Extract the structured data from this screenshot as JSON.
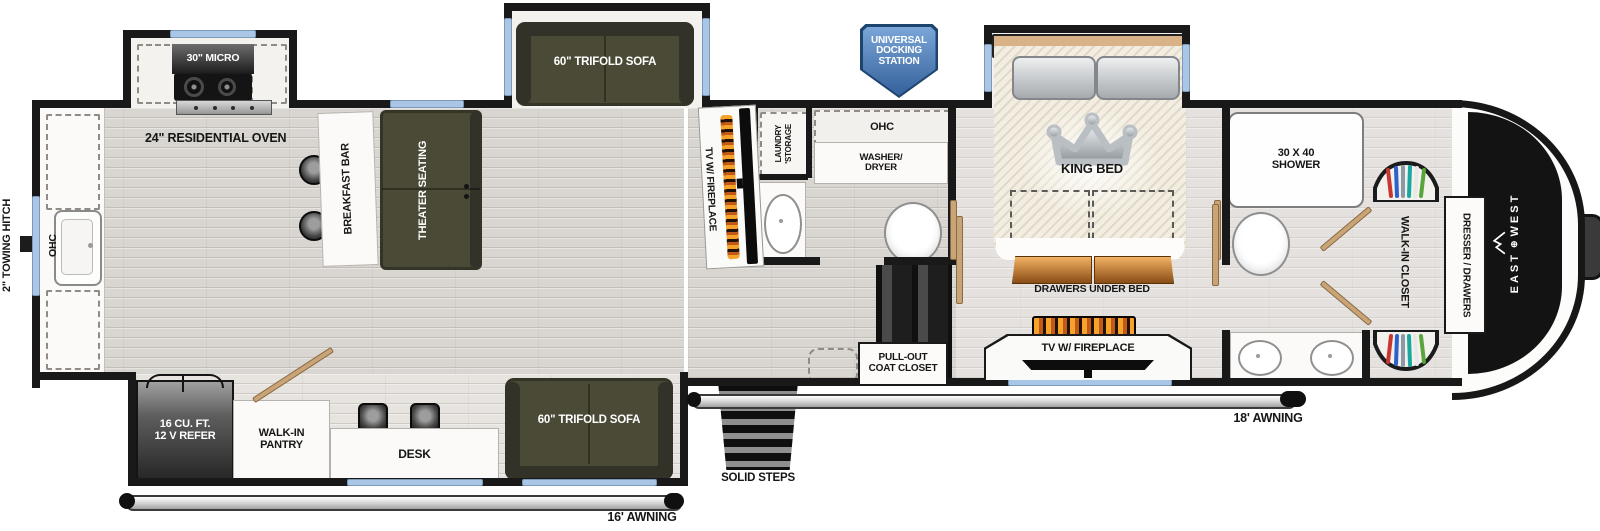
{
  "colors": {
    "wall": "#191919",
    "floor_wood": "#d9d5d0",
    "slide_floor": "#f3f2ef",
    "window_blue": "#a9c6e6",
    "sofa_olive": "#4a4a37",
    "wood_drawers": "#c9803c",
    "badge_blue": "#4a76ad",
    "tan_door": "#c9a477",
    "flame_orange": "#f2a12c"
  },
  "exterior": {
    "towing_hitch": "2\" TOWING HITCH",
    "docking": [
      "UNIVERSAL",
      "DOCKING",
      "STATION"
    ],
    "awning_rear": "16' AWNING",
    "awning_main": "18' AWNING",
    "solid_steps": "SOLID STEPS",
    "brand": {
      "east": "EAST",
      "mark": "⊕",
      "west": "WEST"
    }
  },
  "kitchen": {
    "ohc": "OHC",
    "micro": "30\" MICRO",
    "oven": "24\" RESIDENTIAL OVEN",
    "breakfast_bar": "BREAKFAST BAR",
    "refer": [
      "16 CU. FT.",
      "12 V REFER"
    ],
    "pantry": [
      "WALK-IN",
      "PANTRY"
    ],
    "desk": "DESK"
  },
  "living": {
    "theater": "THEATER SEATING",
    "sofa_top": "60\" TRIFOLD SOFA",
    "sofa_bottom": "60\" TRIFOLD SOFA",
    "tv_fireplace": "TV W/ FIREPLACE",
    "coat_closet": [
      "PULL-OUT",
      "COAT CLOSET"
    ]
  },
  "bath": {
    "laundry": [
      "LAUNDRY",
      "'STORAGE"
    ],
    "ohc": "OHC",
    "washer": [
      "WASHER/",
      "DRYER"
    ]
  },
  "bedroom": {
    "king_bed": "KING BED",
    "drawers": "DRAWERS UNDER BED",
    "tv_fireplace": "TV W/ FIREPLACE"
  },
  "front_bath": {
    "shower": [
      "30 X 40",
      "SHOWER"
    ],
    "walk_in_closet": "WALK-IN CLOSET",
    "dresser": "DRESSER / DRAWERS"
  }
}
